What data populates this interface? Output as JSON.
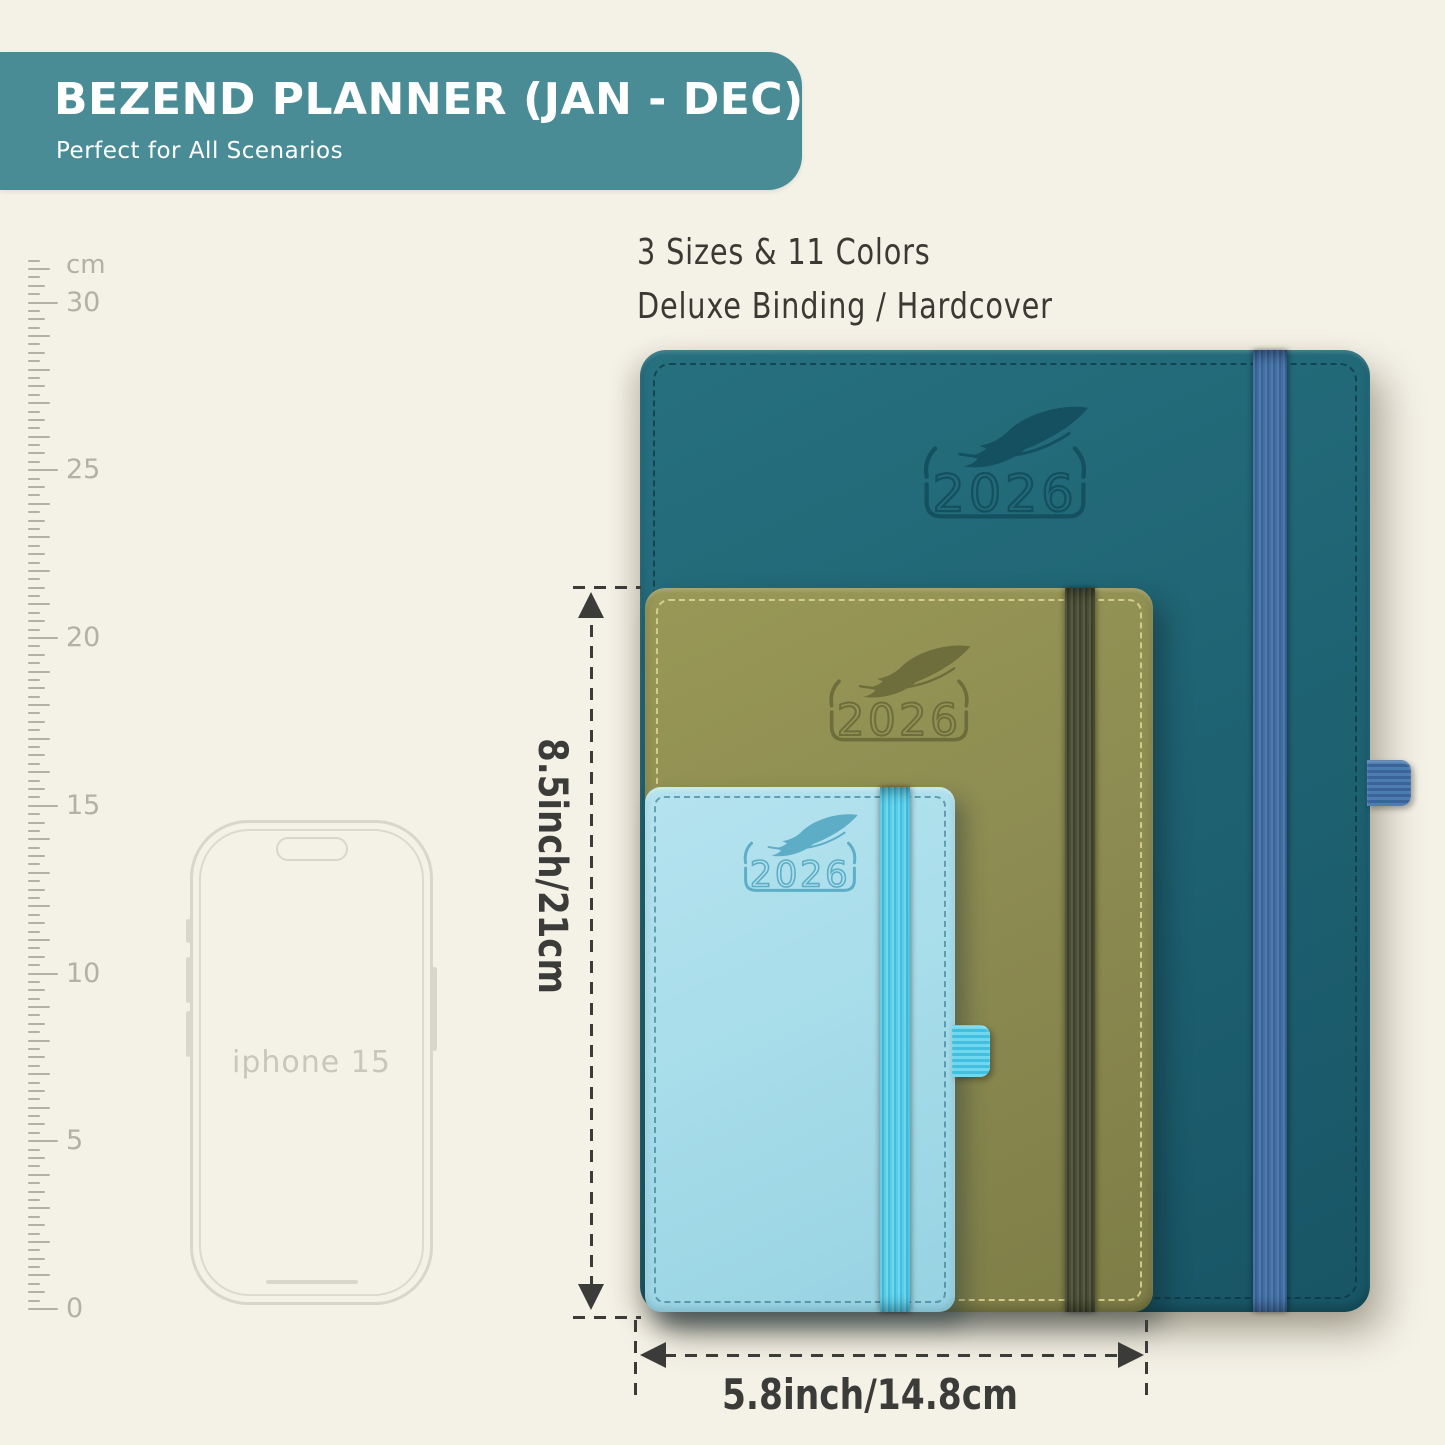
{
  "header": {
    "title": "BEZEND PLANNER (JAN - DEC)",
    "subtitle": "Perfect for All Scenarios",
    "banner_color": "#4A8C95"
  },
  "note": {
    "line1": "3 Sizes & 11 Colors",
    "line2": "Deluxe Binding / Hardcover"
  },
  "ruler": {
    "unit": "cm",
    "px_per_cm": 33.55,
    "max_quarter_ticks": 125,
    "labels": [
      {
        "value": 30,
        "text": "30"
      },
      {
        "value": 25,
        "text": "25"
      },
      {
        "value": 20,
        "text": "20"
      },
      {
        "value": 15,
        "text": "15"
      },
      {
        "value": 10,
        "text": "10"
      },
      {
        "value": 5,
        "text": "5"
      },
      {
        "value": 0,
        "text": "0"
      }
    ]
  },
  "phone": {
    "label": "iphone 15"
  },
  "planners": [
    {
      "id": "large-teal",
      "year": "2026",
      "cover_color": "#1F6474",
      "band_color": "#44699D"
    },
    {
      "id": "medium-olive",
      "year": "2026",
      "cover_color": "#8D8C52",
      "band_color": "#4B4F39"
    },
    {
      "id": "small-blue",
      "year": "2026",
      "cover_color": "#A8DDEA",
      "band_color": "#52CBE9"
    }
  ],
  "dimensions": {
    "height_label": "8.5inch/21cm",
    "width_label": "5.8inch/14.8cm"
  },
  "colors": {
    "background": "#F4F1E6",
    "annotation": "#3B3B39",
    "ruler": "#B3B0A6"
  }
}
